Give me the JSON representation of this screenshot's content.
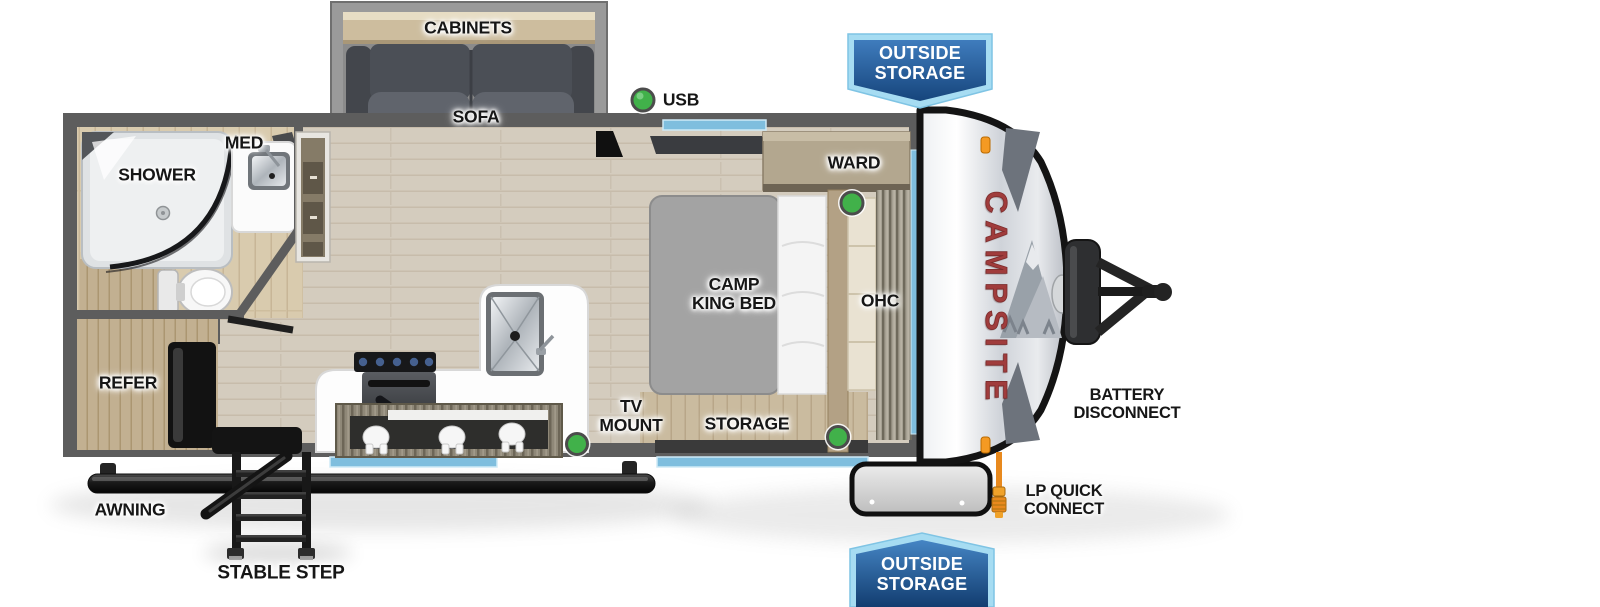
{
  "floorplan": {
    "brand_graphic": "CAMPSITE",
    "labels": {
      "cabinets": "CABINETS",
      "sofa": "SOFA",
      "usb": "USB",
      "ward": "WARD",
      "med": "MED",
      "shower": "SHOWER",
      "camp_king_bed": "CAMP\nKING BED",
      "ohc": "OHC",
      "refer": "REFER",
      "tv_mount": "TV\nMOUNT",
      "storage": "STORAGE",
      "battery_disconnect": "BATTERY\nDISCONNECT",
      "lp_quick_connect": "LP QUICK\nCONNECT",
      "awning": "AWNING",
      "stable_step": "STABLE STEP"
    },
    "badges": {
      "top_text": "OUTSIDE\nSTORAGE",
      "bottom_text": "OUTSIDE\nSTORAGE"
    },
    "indicators": {
      "count": 4,
      "color": "#41b14a",
      "meaning": "green dot markers (USB / light points)"
    },
    "colors": {
      "accent_window_blue": "#7fbede",
      "badge_border_blue": "#a6dcf2",
      "badge_fill_blue": "#2a65a8",
      "logo_red": "#a03c3c",
      "wall_gray": "#5d5d5d",
      "green_indicator": "#41b14a",
      "lp_hose_orange": "#e8891d"
    }
  }
}
